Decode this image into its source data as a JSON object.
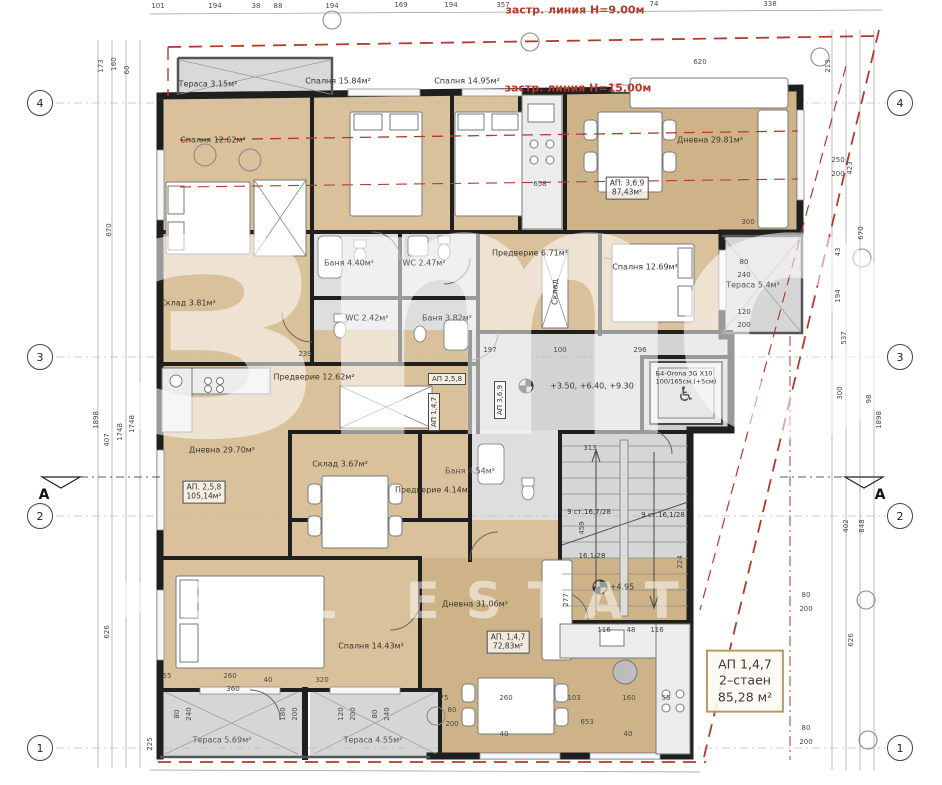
{
  "building_lines": {
    "h9": "застр. линия Н=9.00м",
    "h15": "застр. линия Н=15.00м"
  },
  "watermark": {
    "logo": "зmо",
    "subtext": "REAL ESTATE"
  },
  "grid": {
    "left": [
      "4",
      "3",
      "2",
      "1"
    ],
    "right": [
      "4",
      "3",
      "2",
      "1"
    ],
    "section": "A"
  },
  "rooms": [
    {
      "name": "terrace-top-left",
      "label": "Тераса 3.15м²"
    },
    {
      "name": "bedroom-12-62",
      "label": "Спалня 12.62м²"
    },
    {
      "name": "bedroom-15-84",
      "label": "Спалня 15.84м²"
    },
    {
      "name": "bedroom-14-95",
      "label": "Спалня 14.95м²"
    },
    {
      "name": "living-29-81",
      "label": "Дневна 29.81м²"
    },
    {
      "name": "hall-6-71",
      "label": "Предверие 6.71м²"
    },
    {
      "name": "bath-4-40",
      "label": "Баня 4.40м²"
    },
    {
      "name": "wc-2-47",
      "label": "WC 2.47м²"
    },
    {
      "name": "bedroom-12-69",
      "label": "Спалня 12.69м²"
    },
    {
      "name": "terrace-right",
      "label": "Тераса 5.4м²"
    },
    {
      "name": "storage-3-81",
      "label": "Склад 3.81м²"
    },
    {
      "name": "wc-2-42",
      "label": "WC 2.42м²"
    },
    {
      "name": "bath-3-82",
      "label": "Баня 3.82м²"
    },
    {
      "name": "hall-12-62",
      "label": "Предверие 12.62м²"
    },
    {
      "name": "living-29-70",
      "label": "Дневна 29.70м²"
    },
    {
      "name": "storage-3-67",
      "label": "Склад 3.67м²"
    },
    {
      "name": "hall-4-14",
      "label": "Предверие 4.14м²"
    },
    {
      "name": "bath-4-54",
      "label": "Баня 4.54м²"
    },
    {
      "name": "living-31-06",
      "label": "Дневна 31.06м²"
    },
    {
      "name": "bedroom-14-43",
      "label": "Спалня 14.43м²"
    },
    {
      "name": "terrace-5-69",
      "label": "Тераса 5.69м²"
    },
    {
      "name": "terrace-4-55",
      "label": "Тераса 4.55м²"
    },
    {
      "name": "closet",
      "label": "Склад"
    }
  ],
  "apartments": {
    "ap258_tag": "АП 2,5,8",
    "ap147_tag": "АП 1,4,7",
    "ap369_tag": "АП 3,6,9",
    "ap369_box": {
      "line1": "АП. 3,6,9",
      "line2": "87,43м²"
    },
    "ap258_box": {
      "line1": "АП. 2,5,8",
      "line2": "105,14м²"
    },
    "ap147_box": {
      "line1": "АП. 1,4,7",
      "line2": "72,83м²"
    },
    "info_box": {
      "line1": "АП 1,4,7",
      "line2": "2–стаен",
      "line3": "85,28 м²"
    }
  },
  "annotations": {
    "levels": "+3.50, +6.40, +9.30",
    "level_stair": "+4.95",
    "elevator_line1": "Б4-Orona 3G X10",
    "elevator_line2": "100/165см.(+5см)",
    "stair_run_left": "9 ст.16,7/28",
    "stair_run_right": "9 ст.16,1/28",
    "stair_run_mid": "16,1/28",
    "stair_dim": "459"
  },
  "dims": {
    "top": [
      "101",
      "194",
      "38",
      "88",
      "194",
      "169",
      "194",
      "357",
      "74",
      "338"
    ],
    "left": [
      "173",
      "160",
      "60",
      "670",
      "1898",
      "1748",
      "1748",
      "407",
      "626",
      "225"
    ],
    "right": [
      "213",
      "250",
      "200",
      "423",
      "670",
      "43",
      "194",
      "537",
      "300",
      "98",
      "1898",
      "402",
      "848",
      "626",
      "80",
      "200",
      "80",
      "200"
    ],
    "bottom": [
      "55",
      "260",
      "360",
      "320",
      "40",
      "80",
      "240",
      "180",
      "200",
      "120",
      "200",
      "80",
      "240",
      "80",
      "200",
      "75",
      "260",
      "103",
      "160",
      "55",
      "653",
      "40",
      "40",
      "116",
      "48",
      "116"
    ],
    "inner": [
      "239",
      "197",
      "100",
      "296",
      "620",
      "658",
      "300",
      "313",
      "277",
      "224",
      "80",
      "240",
      "120",
      "200"
    ]
  }
}
